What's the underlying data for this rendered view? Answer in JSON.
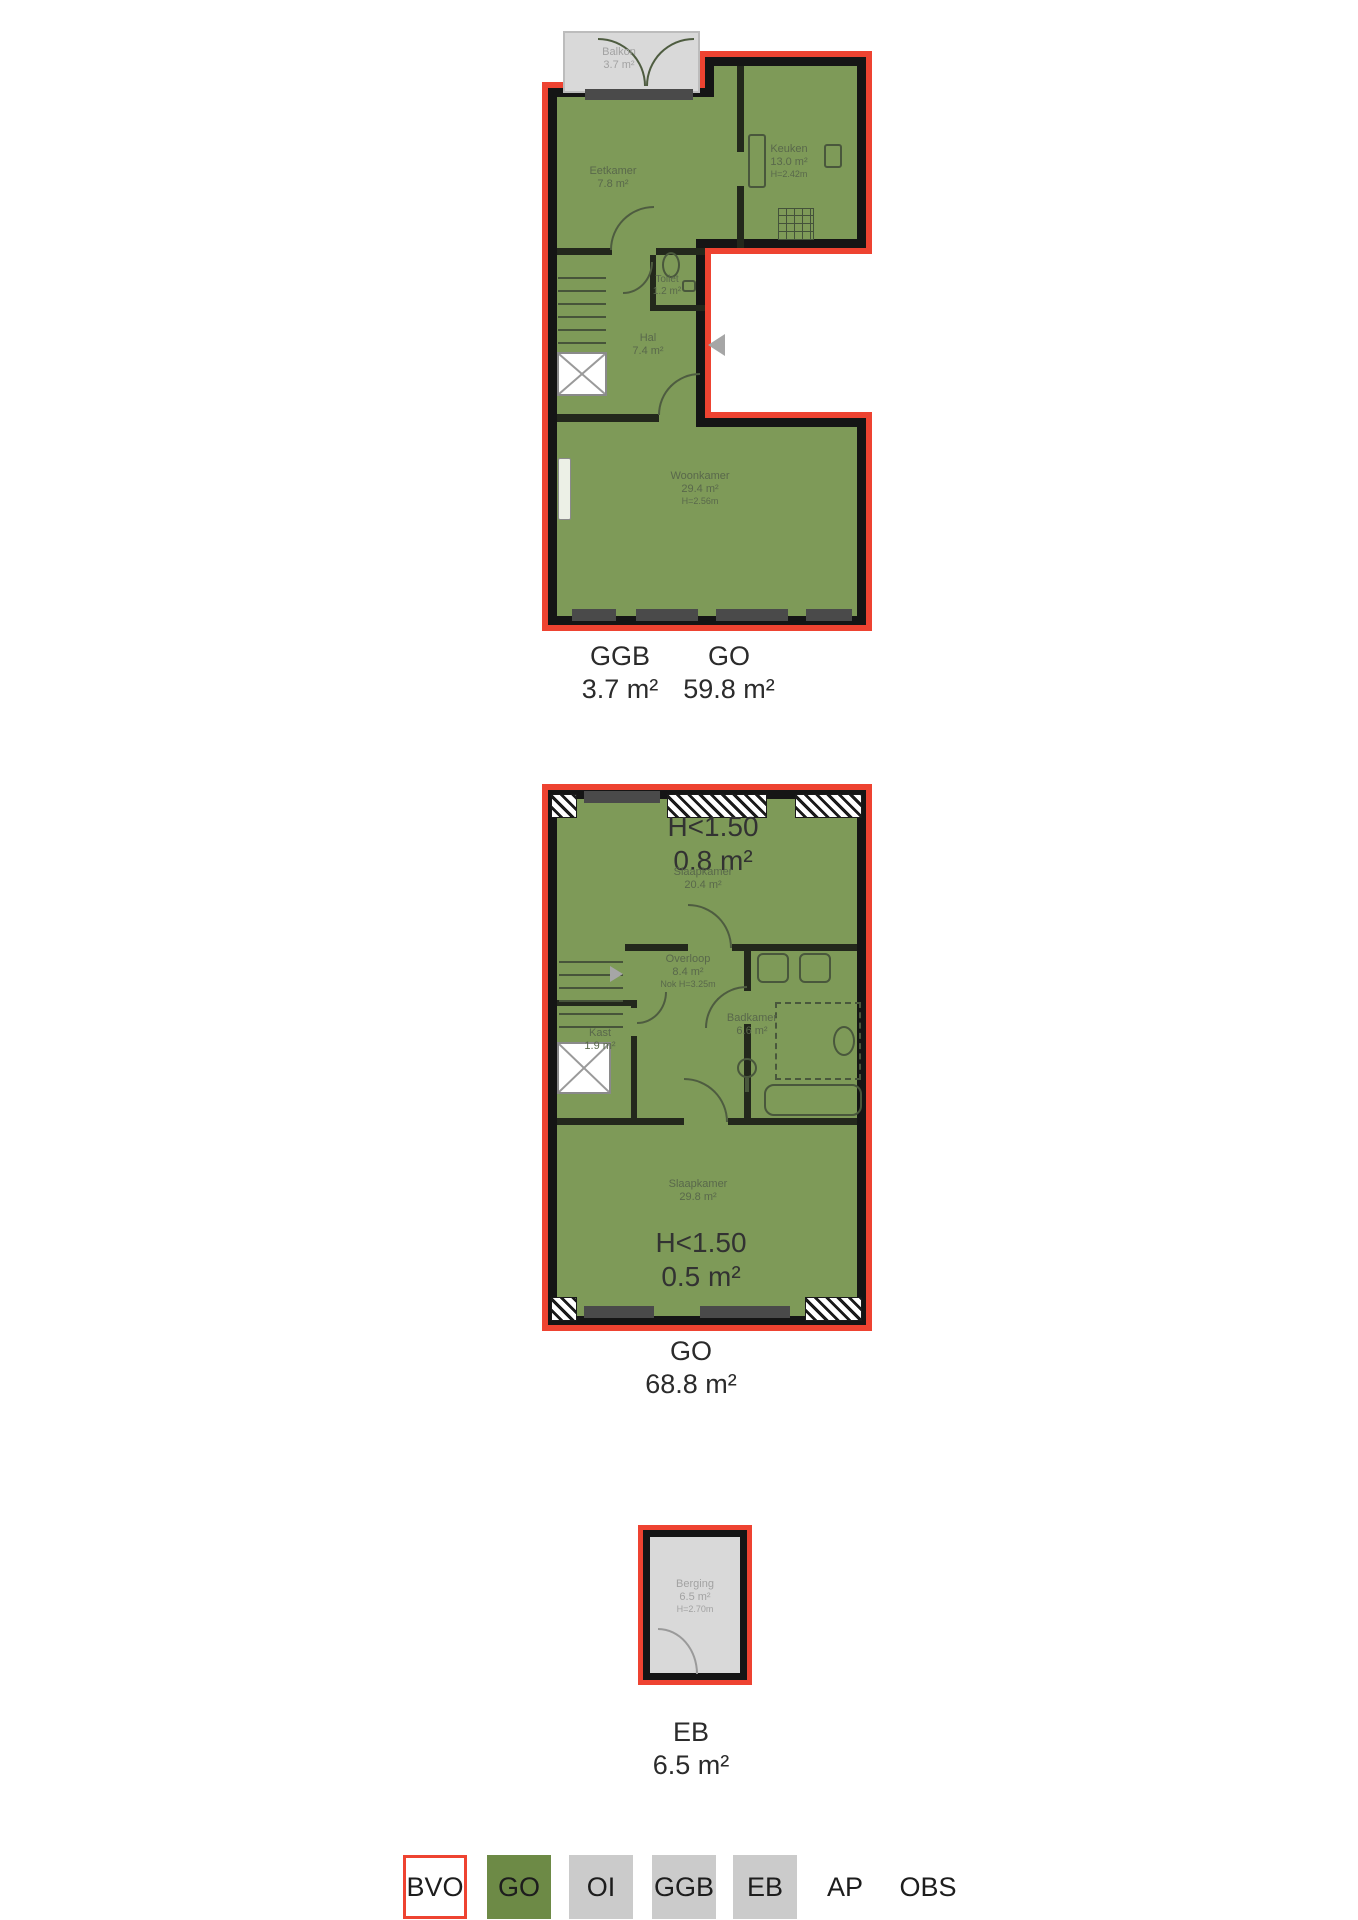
{
  "colors": {
    "go_fill": "#7e9a58",
    "outline_red": "#ee4331",
    "wall_black": "#151515",
    "gray_fill": "#d9d9d9",
    "legend_green": "#6d8a46",
    "legend_gray": "#cbcbcb"
  },
  "plans": [
    {
      "id": "floor-1",
      "rooms": {
        "balkon": {
          "name": "Balkon",
          "area": "3.7 m²"
        },
        "eetkamer": {
          "name": "Eetkamer",
          "area": "7.8 m²"
        },
        "keuken": {
          "name": "Keuken",
          "area": "13.0 m²",
          "height": "H=2.42m"
        },
        "toilet": {
          "name": "Toilet",
          "area": "1.2 m²"
        },
        "hal": {
          "name": "Hal",
          "area": "7.4 m²"
        },
        "woonkamer": {
          "name": "Woonkamer",
          "area": "29.4 m²",
          "height": "H=2.56m"
        }
      },
      "totals": [
        {
          "code": "GGB",
          "value": "3.7 m²"
        },
        {
          "code": "GO",
          "value": "59.8 m²"
        }
      ]
    },
    {
      "id": "floor-2",
      "annotations": [
        {
          "label": "H<1.50",
          "value": "0.8 m²"
        },
        {
          "label": "H<1.50",
          "value": "0.5 m²"
        }
      ],
      "rooms": {
        "slaapkamer1": {
          "name": "Slaapkamer",
          "area": "20.4 m²"
        },
        "overloop": {
          "name": "Overloop",
          "area": "8.4 m²",
          "height": "Nok H=3.25m"
        },
        "kast": {
          "name": "Kast",
          "area": "1.9 m²"
        },
        "badkamer": {
          "name": "Badkamer",
          "area": "6.6 m²"
        },
        "slaapkamer2": {
          "name": "Slaapkamer",
          "area": "29.8 m²"
        }
      },
      "totals": [
        {
          "code": "GO",
          "value": "68.8 m²"
        }
      ]
    },
    {
      "id": "storage",
      "rooms": {
        "berging": {
          "name": "Berging",
          "area": "6.5 m²",
          "height": "H=2.70m"
        }
      },
      "totals": [
        {
          "code": "EB",
          "value": "6.5 m²"
        }
      ]
    }
  ],
  "legend": {
    "items": [
      {
        "code": "BVO"
      },
      {
        "code": "GO"
      },
      {
        "code": "OI"
      },
      {
        "code": "GGB"
      },
      {
        "code": "EB"
      },
      {
        "code": "AP"
      },
      {
        "code": "OBS"
      }
    ]
  }
}
